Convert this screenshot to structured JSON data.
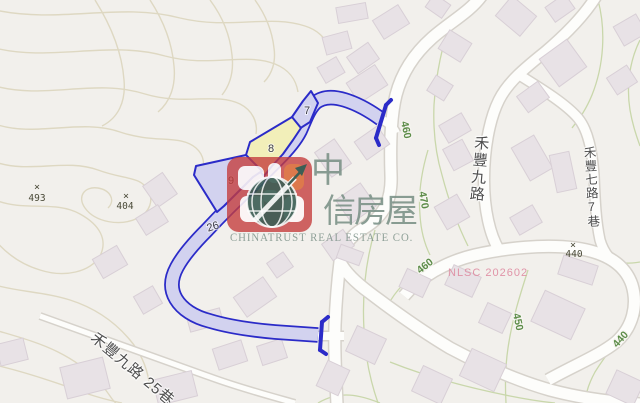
{
  "map": {
    "watermark": {
      "cjk_line1": "中",
      "cjk_line2": "信房屋",
      "tagline": "CHINATRUST REAL ESTATE CO.",
      "brand_red": "#c43c3c",
      "brand_orange": "#dd7038",
      "globe_teal": "#2a4f45",
      "text_green_grey": "#7e938c"
    },
    "parcels": {
      "labels": {
        "lot7": "7",
        "lot8": "8",
        "lot9": "9",
        "lot26": "26"
      },
      "outline_color": "#2b2bc8",
      "highlight_fill": "#d2d2ef",
      "subject_fill": "#f2efb9"
    },
    "road_names": {
      "hefeng_9th_rd": "禾豐九路",
      "hefeng_7th_rd_lane7": "禾豐七路7巷",
      "hefeng_9th_rd_lane25": "禾豐九路 25巷"
    },
    "contour_labels": {
      "c460_top": "460",
      "c470": "470",
      "c460_mid": "460",
      "c450": "450",
      "c440_low": "440"
    },
    "spot_heights": {
      "marker": "×",
      "h493": "493",
      "h404": "404",
      "h440": "440"
    },
    "annotation": {
      "nlsc_code": "NLSC 202602",
      "color": "#df8ba1"
    }
  }
}
